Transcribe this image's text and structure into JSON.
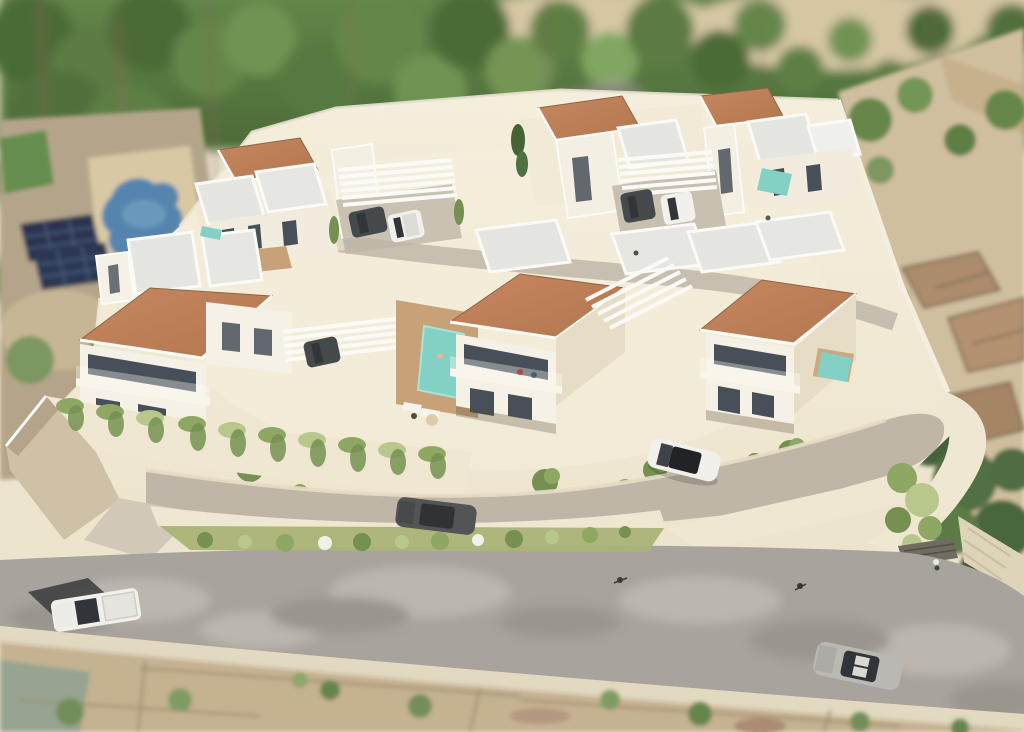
{
  "scene": {
    "title": "Aerial 3D architectural render of a hillside villa development",
    "environment": {
      "top": "blurred band of green trees with sandy clearings and a mauve dirt path behind the site wall",
      "left": "neighbouring plot with freeform blue swimming pool, two dark solar panel arrays and scrub ground",
      "right": "sandy vacant lot with low stone ruins, a palm tree and a large green tree at the corner",
      "bottom": "public asphalt road over an existing aerial photo of rural plots"
    },
    "development": {
      "front_row_villas": 3,
      "back_row_villas": 6,
      "terracotta_roofs": 6,
      "flat_white_roof_volumes": 12,
      "pergola_carports": 3,
      "swimming_pools": 4,
      "retaining_wall": "cream retaining wall with hanging greenery along the lower edge",
      "hedge_median": "green shrub strip with white flowers between private and public roads"
    },
    "vehicles": {
      "white_pickup_main_road": 1,
      "silver_car_main_road": 1,
      "white_suv_internal_road": 1,
      "dark_suv_internal_road": 1,
      "carport_cars": 5
    },
    "people_visible": 8
  },
  "palette": {
    "tree_dark": "#43652f",
    "tree_mid": "#5d8243",
    "tree_light": "#7ba35b",
    "trunk": "#7b5f49",
    "sand": "#d5c5a2",
    "soil": "#c2ab85",
    "path_mauve": "#a88fa2",
    "lawn": "#5e8a47",
    "pool_blue": "#4e80ac",
    "pool_teal": "#7ed0c3",
    "solar_dark": "#202c49",
    "solar_grid": "#44587e",
    "deck_wood": "#c69e72",
    "platform": "#eee4cd",
    "platform_light": "#f6efdd",
    "wall_bright": "#f0e7d2",
    "wall_shadow": "#cdbfa3",
    "wall_dark": "#b2a286",
    "villa_front": "#f6f2e7",
    "villa_side": "#e7dcc6",
    "roof": "#b07148",
    "roof_light": "#c5825a",
    "roof_dark": "#8a5c3c",
    "flat_roof": "#e5e6e3",
    "flat_roof_trim": "#fcfbf8",
    "glazing": "#3f4852",
    "road_internal": "#bdb4a5",
    "sidewalk": "#e7ddc5",
    "road_main": "#a5a099",
    "road_light": "#cac5bd",
    "road_dark": "#8a857e",
    "curb": "#e2d8c0",
    "median_green": "#a8b173",
    "bush_dark": "#6f8c4a",
    "bush_mid": "#8aa45c",
    "bush_light": "#b6c687",
    "ruin": "#a98767",
    "ruin_edge": "#6f5947",
    "field_teal": "#93a18e",
    "car_white": "#f2f1ed",
    "car_dark": "#3e4144",
    "car_charcoal": "#4a4c4e",
    "car_silver": "#b7b6b2",
    "glass": "#282c31",
    "shadow": "rgba(80,66,46,0.28)"
  }
}
